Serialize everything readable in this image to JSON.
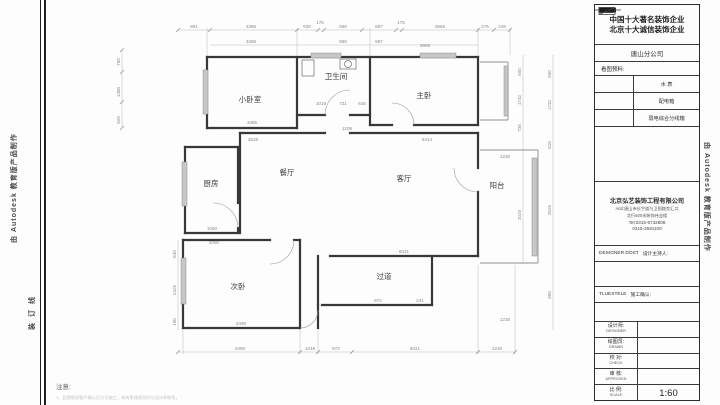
{
  "edges": {
    "autodesk_left": "由 Autodesk 教育版产品制作",
    "binding_line": "装订线",
    "autodesk_right": "由 Autodesk 教育版产品制作"
  },
  "note": {
    "label": "注意:",
    "line": "1、此图纸经客户确认后方可施工，如有更改请及时与设计师联系。"
  },
  "title_block": {
    "slogan_line1": "中国十大著名装饰企业",
    "slogan_line2": "北京十大诚信装饰企业",
    "branch": "唐山分公司",
    "legend_header": "看图预料:",
    "legend": [
      {
        "icon": "water-meter-icon",
        "label": "水 表"
      },
      {
        "icon": "distribution-box-icon",
        "label": "配电箱"
      },
      {
        "icon": "weak-current-box-icon",
        "label": "弱电综合分线箱"
      }
    ],
    "company": {
      "name": "北京弘艺装饰工程有限公司",
      "address1": "Add:唐山市长宁道与卫国路交汇口",
      "address2": "北行500米装饰伟业楼",
      "tel1": "Tel:0315-6732808",
      "tel2": "0315-2591100"
    },
    "host": {
      "en": "DESIGNER DOST",
      "zh": "设计主持人:"
    },
    "confirm": {
      "en": "TLUESTELE",
      "zh": "施工确认:"
    },
    "rows": [
      {
        "zh": "设计师:",
        "en": "DESIGNER",
        "value": ""
      },
      {
        "zh": "绘图员:",
        "en": "DRAWN",
        "value": ""
      },
      {
        "zh": "校 对:",
        "en": "CHECK",
        "value": ""
      },
      {
        "zh": "审 核:",
        "en": "APPROVED",
        "value": ""
      },
      {
        "zh": "比 例:",
        "en": "SCALE",
        "value": "1:60"
      }
    ]
  },
  "plan": {
    "rooms": {
      "small_bedroom": "小卧室",
      "bathroom": "卫生间",
      "master_bedroom": "主卧",
      "kitchen": "厨房",
      "dining": "餐厅",
      "living": "客厅",
      "balcony": "阳台",
      "second_bedroom": "次卧",
      "hallway": "过道"
    },
    "dims": {
      "top": [
        "981",
        "3386",
        "938",
        "175",
        "968",
        "887",
        "175",
        "3966",
        "275",
        "248"
      ],
      "top_inner": [
        "3386",
        "968",
        "887",
        "3966"
      ],
      "left_upper": [
        "780",
        "1480",
        "920"
      ],
      "left_lower": [
        "640",
        "2425",
        "190"
      ],
      "right_inner": [
        "500",
        "1732",
        "738",
        "2025"
      ],
      "right_outer": [
        "500",
        "1732",
        "818",
        "2525",
        "950"
      ],
      "bottom": [
        "3490",
        "1248",
        "972",
        "6021",
        "1230"
      ],
      "inner": [
        "3385",
        "3528",
        "1209",
        "5414",
        "1019",
        "731",
        "648",
        "1060",
        "2090",
        "6021",
        "872",
        "241",
        "3490",
        "1230",
        "1230"
      ]
    }
  }
}
